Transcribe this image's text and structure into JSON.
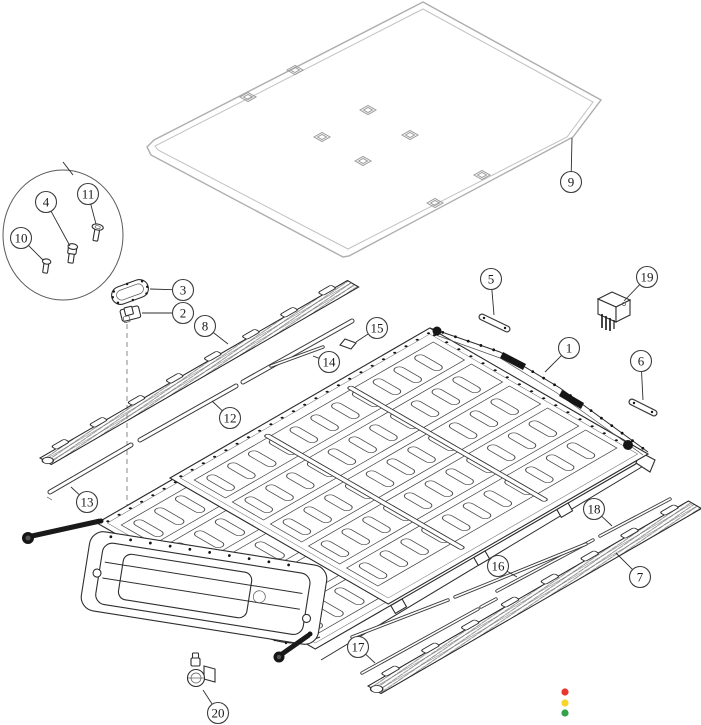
{
  "diagram": {
    "kind": "exploded-parts-diagram",
    "subject": "battery-pack-exploded-view",
    "callouts": [
      {
        "label": "1",
        "x": 569,
        "y": 348,
        "tx": 545,
        "ty": 372
      },
      {
        "label": "2",
        "x": 183,
        "y": 313,
        "tx": 142,
        "ty": 313
      },
      {
        "label": "3",
        "x": 183,
        "y": 290,
        "tx": 150,
        "ty": 289
      },
      {
        "label": "4",
        "x": 46,
        "y": 202,
        "tx": 70,
        "ty": 246
      },
      {
        "label": "5",
        "x": 491,
        "y": 279,
        "tx": 494,
        "ty": 315
      },
      {
        "label": "6",
        "x": 641,
        "y": 361,
        "tx": 643,
        "ty": 400
      },
      {
        "label": "7",
        "x": 640,
        "y": 577,
        "tx": 616,
        "ty": 553
      },
      {
        "label": "8",
        "x": 205,
        "y": 326,
        "tx": 228,
        "ty": 344
      },
      {
        "label": "9",
        "x": 571,
        "y": 182,
        "tx": 572,
        "ty": 138
      },
      {
        "label": "10",
        "x": 21,
        "y": 238,
        "tx": 43,
        "ty": 260
      },
      {
        "label": "11",
        "x": 88,
        "y": 194,
        "tx": 96,
        "ty": 224
      },
      {
        "label": "12",
        "x": 230,
        "y": 418,
        "tx": 212,
        "ty": 401
      },
      {
        "label": "13",
        "x": 87,
        "y": 502,
        "tx": 71,
        "ty": 487
      },
      {
        "label": "14",
        "x": 329,
        "y": 362,
        "tx": 313,
        "ty": 356
      },
      {
        "label": "15",
        "x": 377,
        "y": 328,
        "tx": 356,
        "ty": 342
      },
      {
        "label": "16",
        "x": 498,
        "y": 566,
        "tx": 517,
        "ty": 577
      },
      {
        "label": "17",
        "x": 358,
        "y": 647,
        "tx": 375,
        "ty": 663
      },
      {
        "label": "18",
        "x": 594,
        "y": 509,
        "tx": 612,
        "ty": 526
      },
      {
        "label": "19",
        "x": 647,
        "y": 277,
        "tx": 624,
        "ty": 301
      },
      {
        "label": "20",
        "x": 218,
        "y": 713,
        "tx": 203,
        "ty": 690
      }
    ],
    "status_dots": [
      {
        "name": "red-dot",
        "color": "#e8372d",
        "x": 565,
        "y": 692
      },
      {
        "name": "yellow-dot",
        "color": "#f6d42a",
        "x": 565,
        "y": 703
      },
      {
        "name": "green-dot",
        "color": "#33a04a",
        "x": 565,
        "y": 713
      }
    ]
  }
}
